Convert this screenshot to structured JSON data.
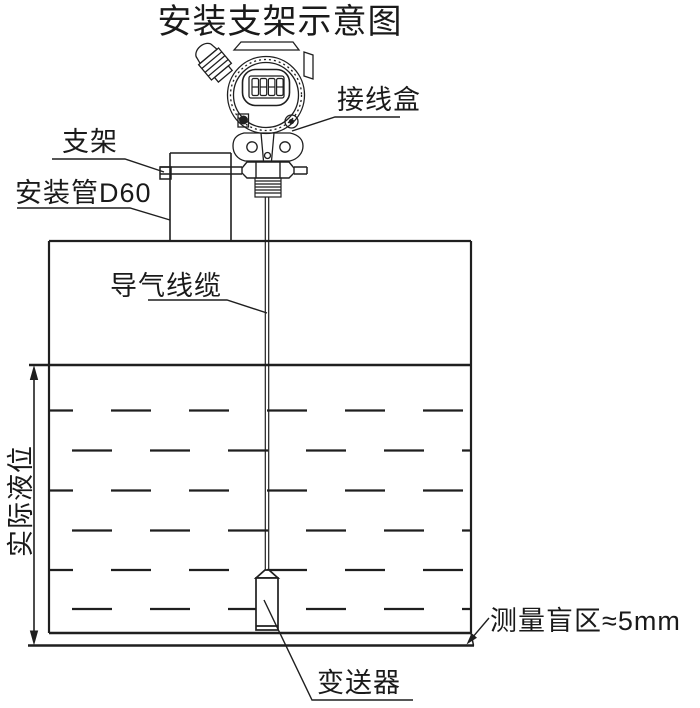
{
  "title": "安装支架示意图",
  "diagram": {
    "labels": {
      "junction_box": "接线盒",
      "bracket": "支架",
      "mounting_pipe": "安装管D60",
      "air_cable": "导气线缆",
      "actual_level": "实际液位",
      "blind_zone": "测量盲区≈5mm",
      "transmitter": "变送器"
    },
    "display_digits": "8888",
    "colors": {
      "line": "#1f1f1f",
      "text": "#1a1a1a",
      "background": "#ffffff"
    }
  }
}
